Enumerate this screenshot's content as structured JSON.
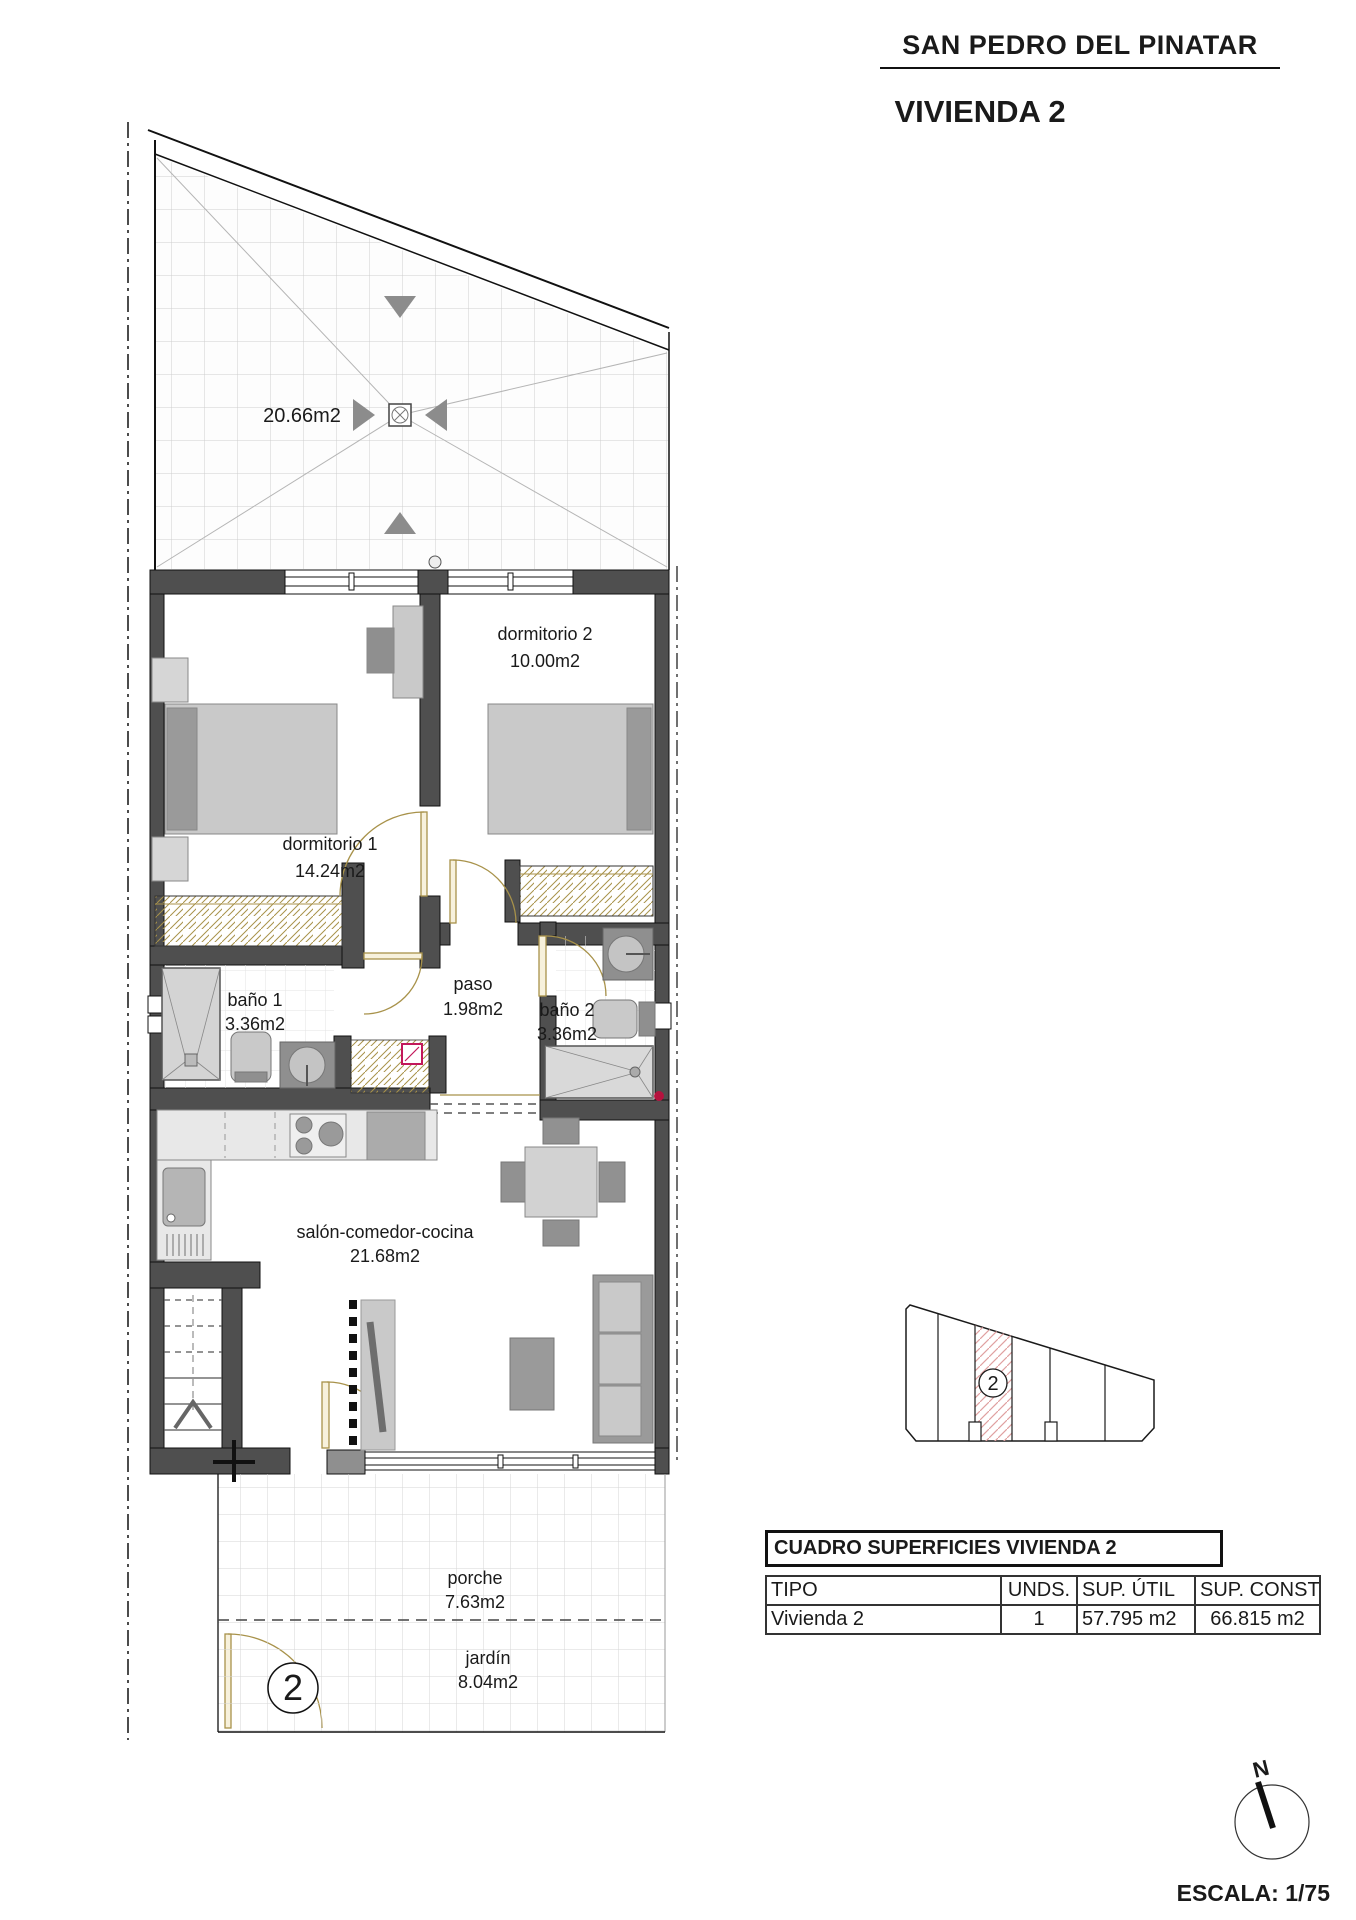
{
  "header": {
    "project": "SAN PEDRO DEL PINATAR",
    "unit": "VIVIENDA 2"
  },
  "plan": {
    "rooms": [
      {
        "id": "solarium",
        "label": "",
        "area": "20.66m2"
      },
      {
        "id": "dormitorio2",
        "label": "dormitorio 2",
        "area": "10.00m2"
      },
      {
        "id": "dormitorio1",
        "label": "dormitorio 1",
        "area": "14.24m2"
      },
      {
        "id": "bano1",
        "label": "baño 1",
        "area": "3.36m2"
      },
      {
        "id": "paso",
        "label": "paso",
        "area": "1.98m2"
      },
      {
        "id": "bano2",
        "label": "baño 2",
        "area": "3.36m2"
      },
      {
        "id": "salon",
        "label": "salón-comedor-cocina",
        "area": "21.68m2"
      },
      {
        "id": "porche",
        "label": "porche",
        "area": "7.63m2"
      },
      {
        "id": "jardin",
        "label": "jardín",
        "area": "8.04m2"
      }
    ],
    "unit_marker": "2"
  },
  "site_plan": {
    "unit_marker": "2"
  },
  "surfaces_table": {
    "title": "CUADRO SUPERFICIES VIVIENDA 2",
    "columns": [
      "TIPO",
      "UNDS.",
      "SUP. ÚTIL",
      "SUP. CONST."
    ],
    "rows": [
      [
        "Vivienda 2",
        "1",
        "57.795 m2",
        "66.815 m2"
      ]
    ]
  },
  "compass": {
    "north_label": "N"
  },
  "scale_label": "ESCALA: 1/75",
  "colors": {
    "wall": "#4F4F4F",
    "furniture_light": "#C9C9C9",
    "furniture_mid": "#9A9A9A",
    "door": "#A8924A",
    "site_hatch": "#E0A0A0",
    "accent_red": "#C2185B"
  }
}
